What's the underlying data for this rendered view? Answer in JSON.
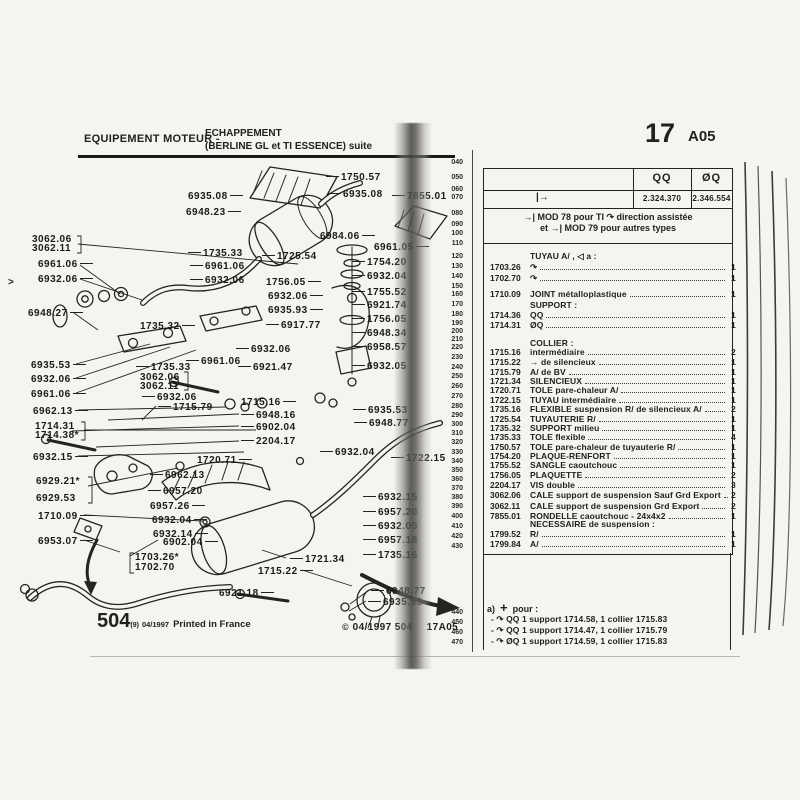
{
  "header": {
    "left_title": "EQUIPEMENT MOTEUR -",
    "left_sub1": "ECHAPPEMENT",
    "left_sub2": "(BERLINE GL et TI ESSENCE) suite",
    "page_number": "17",
    "page_code": "A05"
  },
  "footer": {
    "left_big": "504",
    "left_sup": "(9)",
    "left_date": "04/1997",
    "left_text": "Printed in France",
    "right_copy": "©",
    "right_text": "04/1997 504",
    "right_code": "17A05"
  },
  "ruler": [
    [
      "040",
      162
    ],
    [
      "050",
      177
    ],
    [
      "060",
      189
    ],
    [
      "070",
      197
    ],
    [
      "080",
      213
    ],
    [
      "090",
      224
    ],
    [
      "100",
      233
    ],
    [
      "110",
      243
    ],
    [
      "120",
      256
    ],
    [
      "130",
      266
    ],
    [
      "140",
      276
    ],
    [
      "150",
      286
    ],
    [
      "160",
      294
    ],
    [
      "170",
      304
    ],
    [
      "180",
      314
    ],
    [
      "190",
      323
    ],
    [
      "200",
      331
    ],
    [
      "210",
      339
    ],
    [
      "220",
      347
    ],
    [
      "230",
      357
    ],
    [
      "240",
      367
    ],
    [
      "250",
      376
    ],
    [
      "260",
      386
    ],
    [
      "270",
      396
    ],
    [
      "280",
      406
    ],
    [
      "290",
      415
    ],
    [
      "300",
      424
    ],
    [
      "310",
      433
    ],
    [
      "320",
      442
    ],
    [
      "330",
      452
    ],
    [
      "340",
      461
    ],
    [
      "350",
      470
    ],
    [
      "360",
      479
    ],
    [
      "370",
      488
    ],
    [
      "380",
      497
    ],
    [
      "390",
      506
    ],
    [
      "400",
      516
    ],
    [
      "410",
      526
    ],
    [
      "420",
      536
    ],
    [
      "430",
      546
    ],
    [
      "440",
      612
    ],
    [
      "450",
      622
    ],
    [
      "460",
      632
    ],
    [
      "470",
      642
    ]
  ],
  "table": {
    "col_symbol_a": "QQ",
    "col_symbol_b": "ØQ",
    "arrow_cell": "|→",
    "value_a": "2.324.370",
    "value_b": "2.346.554",
    "mod_note_1": "→| MOD 78 pour TI ↷ direction assistée",
    "mod_note_2": "et →| MOD 79 pour autres types",
    "rows": [
      [
        "",
        "TUYAU A/ , ◁ a :",
        "",
        250,
        0
      ],
      [
        "1703.26",
        "↷",
        "1",
        261,
        1
      ],
      [
        "1702.70",
        "↷",
        "1",
        272,
        1
      ],
      [
        "1710.09",
        "JOINT métalloplastique",
        "1",
        288,
        1
      ],
      [
        "",
        "SUPPORT :",
        "",
        299,
        0
      ],
      [
        "1714.36",
        "QQ",
        "1",
        309,
        1
      ],
      [
        "1714.31",
        "ØQ",
        "1",
        319,
        1
      ],
      [
        "",
        "COLLIER :",
        "",
        337,
        0
      ],
      [
        "1715.16",
        "intermédiaire",
        "2",
        346,
        1
      ],
      [
        "1715.22",
        "→ de silencieux",
        "1",
        356,
        1
      ],
      [
        "1715.79",
        "A/ de BV",
        "1",
        366,
        1
      ],
      [
        "1721.34",
        "SILENCIEUX",
        "1",
        375,
        1
      ],
      [
        "1720.71",
        "TOLE pare-chaleur A/",
        "1",
        384,
        1
      ],
      [
        "1722.15",
        "TUYAU intermédiaire",
        "1",
        394,
        1
      ],
      [
        "1735.16",
        "FLEXIBLE suspension R/ de silencieux A/",
        "2",
        403,
        1
      ],
      [
        "1725.54",
        "TUYAUTERIE R/",
        "1",
        413,
        1
      ],
      [
        "1735.32",
        "SUPPORT milieu",
        "1",
        422,
        1
      ],
      [
        "1735.33",
        "TOLE flexible",
        "4",
        431,
        1
      ],
      [
        "1750.57",
        "TOLE pare-chaleur de tuyauterie R/",
        "1",
        441,
        1
      ],
      [
        "1754.20",
        "PLAQUE-RENFORT",
        "1",
        450,
        1
      ],
      [
        "1755.52",
        "SANGLE caoutchouc",
        "1",
        459,
        1
      ],
      [
        "1756.05",
        "PLAQUETTE",
        "2",
        469,
        1
      ],
      [
        "2204.17",
        "VIS double",
        "3",
        479,
        1
      ],
      [
        "3062.06",
        "CALE support de suspension Sauf Grd Export",
        "2",
        489,
        1
      ],
      [
        "3062.11",
        "CALE support de suspension Grd Export",
        "2",
        500,
        1
      ],
      [
        "7855.01",
        "RONDELLE caoutchouc - 24x4x2",
        "1",
        510,
        1
      ],
      [
        "",
        "NECESSAIRE de suspension :",
        "",
        518,
        0
      ],
      [
        "1799.52",
        "R/",
        "1",
        528,
        1
      ],
      [
        "1799.84",
        "A/",
        "1",
        538,
        1
      ]
    ],
    "note": {
      "marker": "a)",
      "plus": "+",
      "title": "pour :",
      "bullet": "-",
      "arc": "↷",
      "items": [
        {
          "sym": "QQ",
          "text": "1 support 1714.58, 1 collier 1715.83"
        },
        {
          "sym": "QQ",
          "text": "1 support 1714.47, 1 collier 1715.79"
        },
        {
          "sym": "ØQ",
          "text": "1 support 1714.59, 1 collier 1715.83"
        }
      ]
    }
  },
  "diagram": {
    "labels": [
      {
        "t": "1750.57",
        "x": 326,
        "y": 172,
        "ld": "l"
      },
      {
        "t": "6935.08",
        "x": 188,
        "y": 191,
        "ld": "r"
      },
      {
        "t": "6935.08",
        "x": 328,
        "y": 189,
        "ld": "l"
      },
      {
        "t": "6948.23",
        "x": 186,
        "y": 207,
        "ld": "r"
      },
      {
        "t": "7855.01",
        "x": 392,
        "y": 191,
        "ld": "l"
      },
      {
        "t": "6984.06",
        "x": 320,
        "y": 231,
        "ld": "r"
      },
      {
        "t": "6961.05",
        "x": 374,
        "y": 242,
        "ld": "r"
      },
      {
        "t": "3062.06",
        "x": 32,
        "y": 234,
        "ld": "n"
      },
      {
        "t": "3062.11",
        "x": 32,
        "y": 243,
        "ld": "n"
      },
      {
        "t": "6961.06",
        "x": 38,
        "y": 259,
        "ld": "r"
      },
      {
        "t": "6932.06",
        "x": 38,
        "y": 274,
        "ld": "r"
      },
      {
        "t": "1735.33",
        "x": 188,
        "y": 248,
        "ld": "l"
      },
      {
        "t": "6961.06",
        "x": 190,
        "y": 261,
        "ld": "l"
      },
      {
        "t": "6932.06",
        "x": 190,
        "y": 275,
        "ld": "l"
      },
      {
        "t": "1725.54",
        "x": 262,
        "y": 251,
        "ld": "l"
      },
      {
        "t": "6948.27",
        "x": 28,
        "y": 308,
        "ld": "r"
      },
      {
        "t": "1756.05",
        "x": 266,
        "y": 277,
        "ld": "r"
      },
      {
        "t": "6932.06",
        "x": 268,
        "y": 291,
        "ld": "r"
      },
      {
        "t": "6935.93",
        "x": 268,
        "y": 305,
        "ld": "r"
      },
      {
        "t": "1735.32",
        "x": 140,
        "y": 321,
        "ld": "r"
      },
      {
        "t": "6917.77",
        "x": 266,
        "y": 320,
        "ld": "l"
      },
      {
        "t": "6932.06",
        "x": 236,
        "y": 344,
        "ld": "l"
      },
      {
        "t": "6961.06",
        "x": 186,
        "y": 356,
        "ld": "l"
      },
      {
        "t": "6921.47",
        "x": 238,
        "y": 362,
        "ld": "l"
      },
      {
        "t": "1735.33",
        "x": 136,
        "y": 362,
        "ld": "l"
      },
      {
        "t": "3062.06",
        "x": 140,
        "y": 372,
        "ld": "n"
      },
      {
        "t": "3062.11",
        "x": 140,
        "y": 381,
        "ld": "n"
      },
      {
        "t": "6932.06",
        "x": 142,
        "y": 392,
        "ld": "l"
      },
      {
        "t": "6935.53",
        "x": 31,
        "y": 360,
        "ld": "r"
      },
      {
        "t": "6932.06",
        "x": 31,
        "y": 374,
        "ld": "r"
      },
      {
        "t": "6961.06",
        "x": 31,
        "y": 389,
        "ld": "r"
      },
      {
        "t": "1754.20",
        "x": 352,
        "y": 257,
        "ld": "l"
      },
      {
        "t": "6932.04",
        "x": 352,
        "y": 271,
        "ld": "l"
      },
      {
        "t": "1755.52",
        "x": 352,
        "y": 287,
        "ld": "l"
      },
      {
        "t": "6921.74",
        "x": 352,
        "y": 300,
        "ld": "l"
      },
      {
        "t": "1756.05",
        "x": 352,
        "y": 314,
        "ld": "l"
      },
      {
        "t": "6948.34",
        "x": 352,
        "y": 328,
        "ld": "l"
      },
      {
        "t": "6958.57",
        "x": 352,
        "y": 342,
        "ld": "l"
      },
      {
        "t": "6932.05",
        "x": 352,
        "y": 361,
        "ld": "l"
      },
      {
        "t": "6962.13",
        "x": 33,
        "y": 406,
        "ld": "r"
      },
      {
        "t": "1714.31",
        "x": 35,
        "y": 421,
        "ld": "n"
      },
      {
        "t": "1714.38*",
        "x": 35,
        "y": 430,
        "ld": "n"
      },
      {
        "t": "6932.15",
        "x": 33,
        "y": 452,
        "ld": "r"
      },
      {
        "t": "6929.21*",
        "x": 36,
        "y": 476,
        "ld": "n"
      },
      {
        "t": "6929.53",
        "x": 36,
        "y": 493,
        "ld": "n"
      },
      {
        "t": "1710.09",
        "x": 38,
        "y": 511,
        "ld": "r"
      },
      {
        "t": "6953.07",
        "x": 38,
        "y": 536,
        "ld": "r"
      },
      {
        "t": "1715.79",
        "x": 158,
        "y": 402,
        "ld": "l"
      },
      {
        "t": "1715.16",
        "x": 241,
        "y": 397,
        "ld": "r"
      },
      {
        "t": "6948.16",
        "x": 241,
        "y": 410,
        "ld": "l"
      },
      {
        "t": "6902.04",
        "x": 241,
        "y": 422,
        "ld": "l"
      },
      {
        "t": "2204.17",
        "x": 241,
        "y": 436,
        "ld": "l"
      },
      {
        "t": "1720.71",
        "x": 197,
        "y": 455,
        "ld": "r"
      },
      {
        "t": "6932.04",
        "x": 320,
        "y": 447,
        "ld": "l"
      },
      {
        "t": "6935.53",
        "x": 353,
        "y": 405,
        "ld": "l"
      },
      {
        "t": "6948.77",
        "x": 354,
        "y": 418,
        "ld": "l"
      },
      {
        "t": "1722.15",
        "x": 391,
        "y": 453,
        "ld": "l"
      },
      {
        "t": "6962.13",
        "x": 150,
        "y": 470,
        "ld": "l"
      },
      {
        "t": "6957.20",
        "x": 148,
        "y": 486,
        "ld": "l"
      },
      {
        "t": "6957.26",
        "x": 150,
        "y": 501,
        "ld": "r"
      },
      {
        "t": "6932.04",
        "x": 152,
        "y": 515,
        "ld": "r"
      },
      {
        "t": "6932.14",
        "x": 153,
        "y": 529,
        "ld": "r"
      },
      {
        "t": "6902.04",
        "x": 163,
        "y": 537,
        "ld": "r"
      },
      {
        "t": "1721.34",
        "x": 290,
        "y": 554,
        "ld": "l"
      },
      {
        "t": "1715.22",
        "x": 258,
        "y": 566,
        "ld": "r"
      },
      {
        "t": "6921.18",
        "x": 219,
        "y": 588,
        "ld": "r"
      },
      {
        "t": "1703.26*",
        "x": 135,
        "y": 552,
        "ld": "n"
      },
      {
        "t": "1702.70",
        "x": 135,
        "y": 562,
        "ld": "n"
      },
      {
        "t": "6932.15",
        "x": 363,
        "y": 492,
        "ld": "l"
      },
      {
        "t": "6957.20",
        "x": 363,
        "y": 507,
        "ld": "l"
      },
      {
        "t": "6932.05",
        "x": 363,
        "y": 521,
        "ld": "l"
      },
      {
        "t": "6957.18",
        "x": 363,
        "y": 535,
        "ld": "l"
      },
      {
        "t": "1735.16",
        "x": 363,
        "y": 550,
        "ld": "l"
      },
      {
        "t": "6948.77",
        "x": 371,
        "y": 586,
        "ld": "l"
      },
      {
        "t": "6935.53",
        "x": 368,
        "y": 597,
        "ld": "l"
      },
      {
        "t": ">",
        "x": 8,
        "y": 277,
        "ld": "n"
      }
    ]
  }
}
